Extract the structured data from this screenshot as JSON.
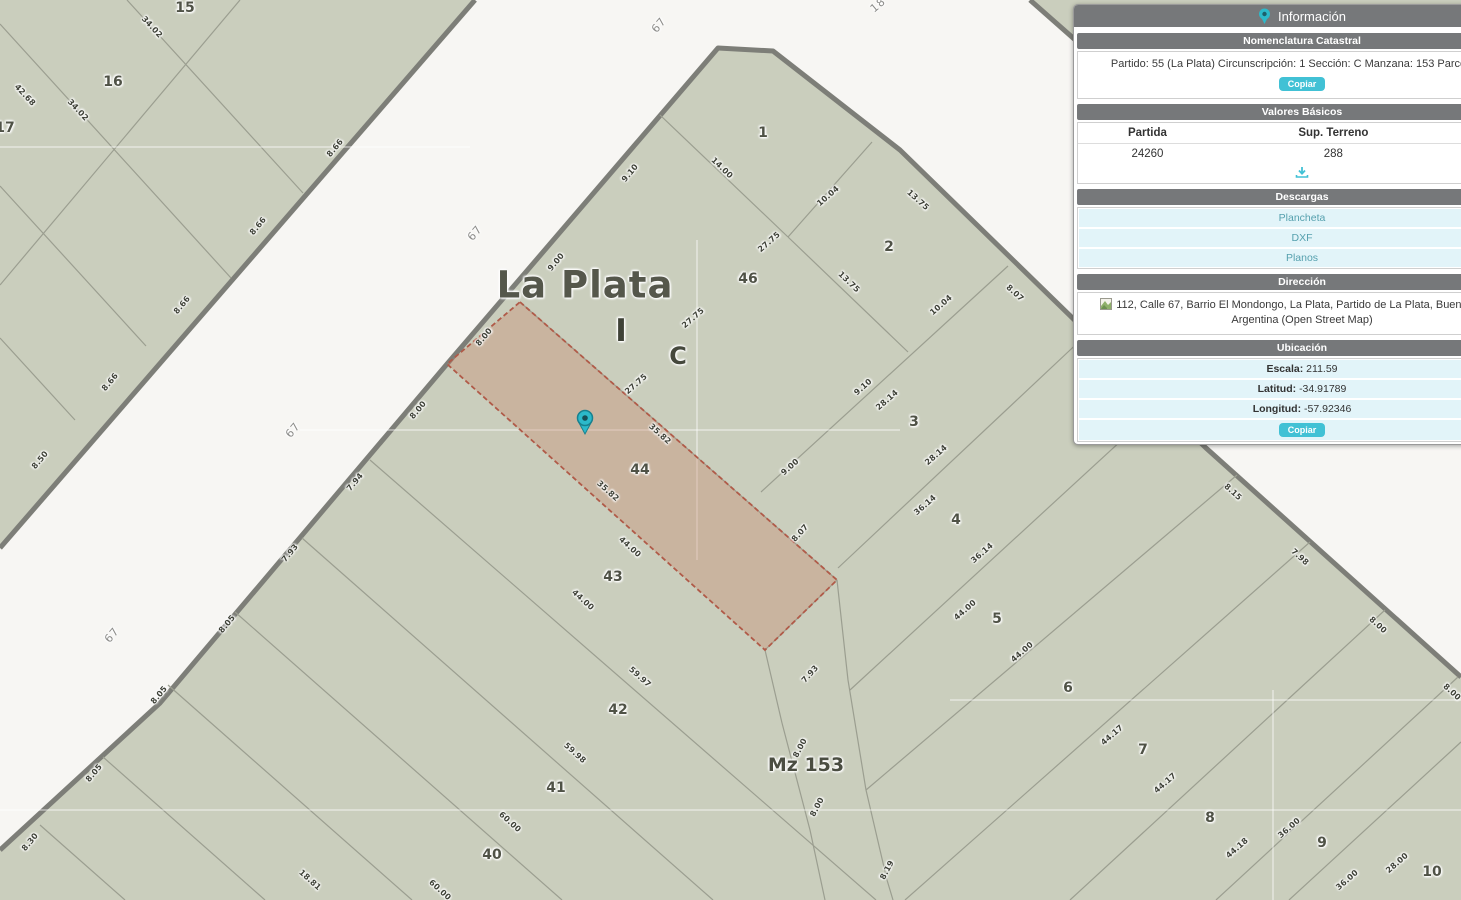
{
  "panel": {
    "title": "Información",
    "nomenclatura": {
      "title": "Nomenclatura Catastral",
      "text": "Partido: 55 (La Plata) Circunscripción: 1 Sección: C Manzana: 153 Parcela: 44",
      "copy": "Copiar"
    },
    "valores": {
      "title": "Valores Básicos",
      "col1": "Partida",
      "col2": "Sup. Terreno",
      "val1": "24260",
      "val2": "288"
    },
    "descargas": {
      "title": "Descargas",
      "link1": "Plancheta",
      "link2": "DXF",
      "link3": "Planos"
    },
    "direccion": {
      "title": "Dirección",
      "line1": "112, Calle 67, Barrio El Mondongo, La Plata, Partido de La Plata, Buenos Aires,",
      "line2": "Argentina (Open Street Map)"
    },
    "ubicacion": {
      "title": "Ubicación",
      "escala_label": "Escala:",
      "escala": "211.59",
      "lat_label": "Latitud:",
      "lat": "-34.91789",
      "lon_label": "Longitud:",
      "lon": "-57.92346",
      "copy": "Copiar"
    }
  },
  "colors": {
    "accent": "#41c1d5",
    "panel_header": "#76787a",
    "row_cyan": "#e2f4f9",
    "map_parcel_fill": "#cacebd",
    "map_street": "#f7f6f3",
    "map_block_border": "#7d7e78",
    "map_parcel_line": "#9b9e90",
    "highlight_fill": "#d9c3b2",
    "highlight_dash": "#b05a48",
    "marker_teal": "#2cb9ca"
  },
  "map": {
    "marker": {
      "x": 585,
      "y": 422
    },
    "labels": [
      {
        "t": "La Plata",
        "x": 585,
        "y": 285,
        "r": 0,
        "k": "city"
      },
      {
        "t": "I",
        "x": 621,
        "y": 331,
        "r": 0,
        "k": "sec1"
      },
      {
        "t": "C",
        "x": 678,
        "y": 356,
        "r": 0,
        "k": "sec2"
      },
      {
        "t": "Mz 153",
        "x": 806,
        "y": 765,
        "r": 0,
        "k": "mz"
      },
      {
        "t": "67",
        "x": 659,
        "y": 25,
        "r": -50,
        "k": "street"
      },
      {
        "t": "67",
        "x": 475,
        "y": 233,
        "r": -50,
        "k": "street"
      },
      {
        "t": "67",
        "x": 293,
        "y": 430,
        "r": -50,
        "k": "street"
      },
      {
        "t": "67",
        "x": 112,
        "y": 635,
        "r": -50,
        "k": "street"
      },
      {
        "t": "18",
        "x": 878,
        "y": 5,
        "r": -40,
        "k": "street"
      },
      {
        "t": "15",
        "x": 185,
        "y": 8,
        "r": 0,
        "k": "parcel"
      },
      {
        "t": "16",
        "x": 113,
        "y": 82,
        "r": 0,
        "k": "parcel"
      },
      {
        "t": "17",
        "x": 5,
        "y": 128,
        "r": 0,
        "k": "parcel"
      },
      {
        "t": "1",
        "x": 763,
        "y": 133,
        "r": 0,
        "k": "parcel"
      },
      {
        "t": "2",
        "x": 889,
        "y": 247,
        "r": 0,
        "k": "parcel"
      },
      {
        "t": "46",
        "x": 748,
        "y": 279,
        "r": 0,
        "k": "parcel"
      },
      {
        "t": "3",
        "x": 914,
        "y": 422,
        "r": 0,
        "k": "parcel"
      },
      {
        "t": "44",
        "x": 640,
        "y": 470,
        "r": 0,
        "k": "parcel"
      },
      {
        "t": "4",
        "x": 956,
        "y": 520,
        "r": 0,
        "k": "parcel"
      },
      {
        "t": "43",
        "x": 613,
        "y": 577,
        "r": 0,
        "k": "parcel"
      },
      {
        "t": "5",
        "x": 997,
        "y": 619,
        "r": 0,
        "k": "parcel"
      },
      {
        "t": "42",
        "x": 618,
        "y": 710,
        "r": 0,
        "k": "parcel"
      },
      {
        "t": "6",
        "x": 1068,
        "y": 688,
        "r": 0,
        "k": "parcel"
      },
      {
        "t": "41",
        "x": 556,
        "y": 788,
        "r": 0,
        "k": "parcel"
      },
      {
        "t": "7",
        "x": 1143,
        "y": 750,
        "r": 0,
        "k": "parcel"
      },
      {
        "t": "40",
        "x": 492,
        "y": 855,
        "r": 0,
        "k": "parcel"
      },
      {
        "t": "8",
        "x": 1210,
        "y": 818,
        "r": 0,
        "k": "parcel"
      },
      {
        "t": "9",
        "x": 1322,
        "y": 843,
        "r": 0,
        "k": "parcel"
      },
      {
        "t": "10",
        "x": 1432,
        "y": 872,
        "r": 0,
        "k": "parcel"
      },
      {
        "t": "34.02",
        "x": 152,
        "y": 27,
        "r": 47,
        "k": "measure"
      },
      {
        "t": "42.68",
        "x": 25,
        "y": 95,
        "r": 47,
        "k": "measure"
      },
      {
        "t": "34.02",
        "x": 78,
        "y": 110,
        "r": 47,
        "k": "measure"
      },
      {
        "t": "8.66",
        "x": 335,
        "y": 148,
        "r": -50,
        "k": "measure"
      },
      {
        "t": "8.66",
        "x": 258,
        "y": 226,
        "r": -50,
        "k": "measure"
      },
      {
        "t": "8.66",
        "x": 182,
        "y": 305,
        "r": -50,
        "k": "measure"
      },
      {
        "t": "8.66",
        "x": 110,
        "y": 382,
        "r": -50,
        "k": "measure"
      },
      {
        "t": "8.50",
        "x": 40,
        "y": 460,
        "r": -50,
        "k": "measure"
      },
      {
        "t": "9.10",
        "x": 630,
        "y": 173,
        "r": -50,
        "k": "measure"
      },
      {
        "t": "9.00",
        "x": 556,
        "y": 262,
        "r": -50,
        "k": "measure"
      },
      {
        "t": "8.00",
        "x": 484,
        "y": 337,
        "r": -50,
        "k": "measure"
      },
      {
        "t": "8.00",
        "x": 418,
        "y": 410,
        "r": -50,
        "k": "measure"
      },
      {
        "t": "7.94",
        "x": 355,
        "y": 482,
        "r": -50,
        "k": "measure"
      },
      {
        "t": "7.93",
        "x": 290,
        "y": 553,
        "r": -50,
        "k": "measure"
      },
      {
        "t": "8.05",
        "x": 227,
        "y": 624,
        "r": -50,
        "k": "measure"
      },
      {
        "t": "8.05",
        "x": 159,
        "y": 695,
        "r": -50,
        "k": "measure"
      },
      {
        "t": "8.05",
        "x": 94,
        "y": 773,
        "r": -50,
        "k": "measure"
      },
      {
        "t": "8.30",
        "x": 30,
        "y": 842,
        "r": -50,
        "k": "measure"
      },
      {
        "t": "14.00",
        "x": 722,
        "y": 168,
        "r": 44,
        "k": "measure"
      },
      {
        "t": "13.75",
        "x": 849,
        "y": 282,
        "r": 44,
        "k": "measure"
      },
      {
        "t": "35.82",
        "x": 660,
        "y": 434,
        "r": 42,
        "k": "measure"
      },
      {
        "t": "35.82",
        "x": 608,
        "y": 491,
        "r": 42,
        "k": "measure"
      },
      {
        "t": "44.00",
        "x": 630,
        "y": 547,
        "r": 42,
        "k": "measure"
      },
      {
        "t": "44.00",
        "x": 583,
        "y": 600,
        "r": 42,
        "k": "measure"
      },
      {
        "t": "59.97",
        "x": 640,
        "y": 677,
        "r": 42,
        "k": "measure"
      },
      {
        "t": "59.98",
        "x": 575,
        "y": 753,
        "r": 42,
        "k": "measure"
      },
      {
        "t": "60.00",
        "x": 510,
        "y": 822,
        "r": 42,
        "k": "measure"
      },
      {
        "t": "60.00",
        "x": 440,
        "y": 890,
        "r": 42,
        "k": "measure"
      },
      {
        "t": "18.81",
        "x": 310,
        "y": 880,
        "r": 42,
        "k": "measure"
      },
      {
        "t": "13.75",
        "x": 918,
        "y": 200,
        "r": 42,
        "k": "measure"
      },
      {
        "t": "8.07",
        "x": 1015,
        "y": 293,
        "r": 42,
        "k": "measure"
      },
      {
        "t": "8.15",
        "x": 1233,
        "y": 492,
        "r": 42,
        "k": "measure"
      },
      {
        "t": "7.98",
        "x": 1300,
        "y": 557,
        "r": 42,
        "k": "measure"
      },
      {
        "t": "8.00",
        "x": 1378,
        "y": 625,
        "r": 42,
        "k": "measure"
      },
      {
        "t": "8.00",
        "x": 1452,
        "y": 692,
        "r": 42,
        "k": "measure"
      },
      {
        "t": "10.04",
        "x": 828,
        "y": 196,
        "r": -41,
        "k": "measure"
      },
      {
        "t": "10.04",
        "x": 941,
        "y": 305,
        "r": -41,
        "k": "measure"
      },
      {
        "t": "9.10",
        "x": 863,
        "y": 387,
        "r": -41,
        "k": "measure"
      },
      {
        "t": "28.14",
        "x": 887,
        "y": 400,
        "r": -41,
        "k": "measure"
      },
      {
        "t": "28.14",
        "x": 936,
        "y": 455,
        "r": -41,
        "k": "measure"
      },
      {
        "t": "36.14",
        "x": 925,
        "y": 505,
        "r": -41,
        "k": "measure"
      },
      {
        "t": "36.14",
        "x": 982,
        "y": 553,
        "r": -41,
        "k": "measure"
      },
      {
        "t": "44.00",
        "x": 965,
        "y": 610,
        "r": -41,
        "k": "measure"
      },
      {
        "t": "44.00",
        "x": 1022,
        "y": 652,
        "r": -41,
        "k": "measure"
      },
      {
        "t": "44.17",
        "x": 1112,
        "y": 735,
        "r": -41,
        "k": "measure"
      },
      {
        "t": "44.17",
        "x": 1165,
        "y": 783,
        "r": -41,
        "k": "measure"
      },
      {
        "t": "44.18",
        "x": 1237,
        "y": 848,
        "r": -41,
        "k": "measure"
      },
      {
        "t": "36.00",
        "x": 1289,
        "y": 828,
        "r": -41,
        "k": "measure"
      },
      {
        "t": "36.00",
        "x": 1347,
        "y": 880,
        "r": -41,
        "k": "measure"
      },
      {
        "t": "28.00",
        "x": 1397,
        "y": 863,
        "r": -41,
        "k": "measure"
      },
      {
        "t": "27.75",
        "x": 769,
        "y": 242,
        "r": -41,
        "k": "measure"
      },
      {
        "t": "27.75",
        "x": 693,
        "y": 318,
        "r": -41,
        "k": "measure"
      },
      {
        "t": "27.75",
        "x": 636,
        "y": 384,
        "r": -41,
        "k": "measure"
      },
      {
        "t": "9.00",
        "x": 790,
        "y": 467,
        "r": -41,
        "k": "measure"
      },
      {
        "t": "8.07",
        "x": 800,
        "y": 533,
        "r": -48,
        "k": "measure"
      },
      {
        "t": "7.93",
        "x": 810,
        "y": 674,
        "r": -48,
        "k": "measure"
      },
      {
        "t": "8.00",
        "x": 800,
        "y": 748,
        "r": -62,
        "k": "measure"
      },
      {
        "t": "8.00",
        "x": 817,
        "y": 807,
        "r": -62,
        "k": "measure"
      },
      {
        "t": "8.19",
        "x": 887,
        "y": 870,
        "r": -62,
        "k": "measure"
      }
    ]
  }
}
